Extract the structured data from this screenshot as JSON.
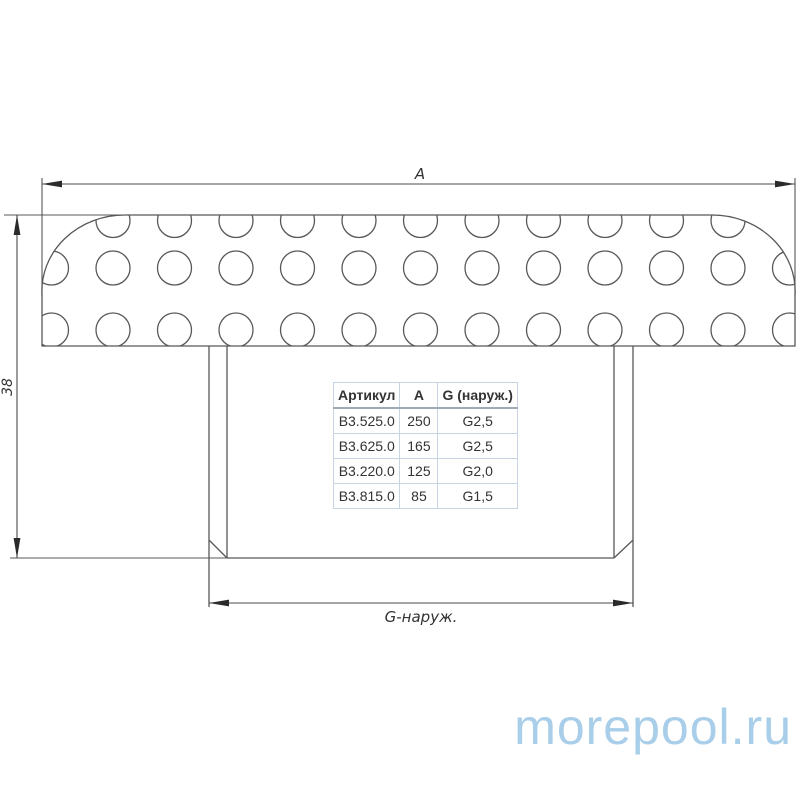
{
  "drawing": {
    "labels": {
      "width_dim": "A",
      "height_dim": "38",
      "thread_dim": "G-наруж."
    },
    "line_color": "#585858",
    "arrow_color": "#2b2b2b",
    "holes": {
      "col_start": 51.5,
      "col_step": 61.5,
      "col_count": 13,
      "row_centers": [
        220.5,
        268,
        330
      ],
      "radius": 17
    }
  },
  "table": {
    "headers": [
      "Артикул",
      "А",
      "G (наруж.)"
    ],
    "rows": [
      [
        "B3.525.0",
        "250",
        "G2,5"
      ],
      [
        "B3.625.0",
        "165",
        "G2,5"
      ],
      [
        "B3.220.0",
        "125",
        "G2,0"
      ],
      [
        "B3.815.0",
        "85",
        "G1,5"
      ]
    ]
  },
  "watermark": {
    "text": "morepool.ru",
    "color": "#a8cee9"
  }
}
